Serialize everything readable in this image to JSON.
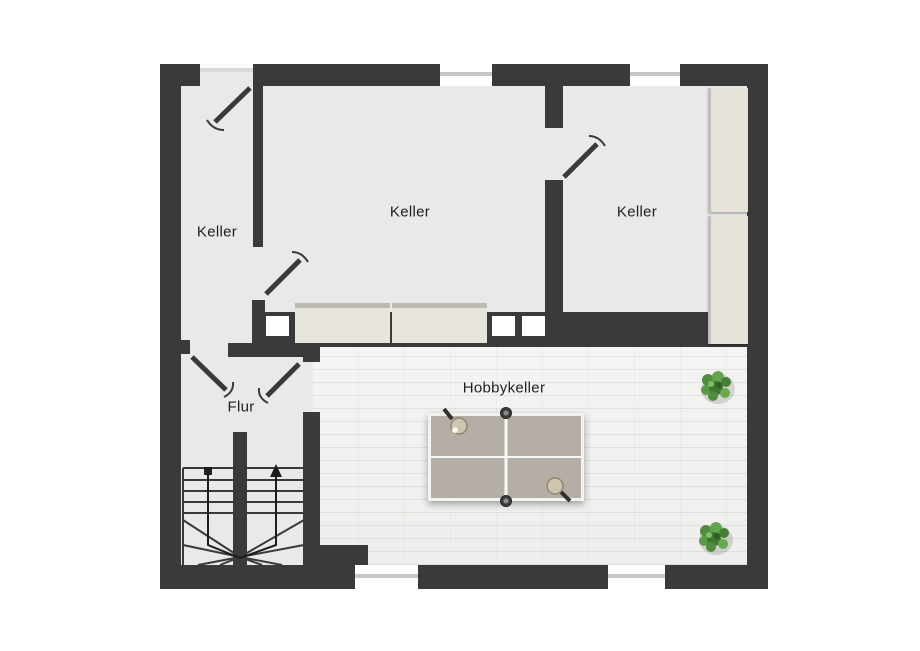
{
  "title": "Kellergeschoss Grundriss",
  "rooms": {
    "keller_left": {
      "label": "Keller"
    },
    "keller_center": {
      "label": "Keller"
    },
    "keller_right": {
      "label": "Keller"
    },
    "flur": {
      "label": "Flur"
    },
    "hobbykeller": {
      "label": "Hobbykeller"
    }
  },
  "colors": {
    "wall": "#3a3a3a",
    "room_floor": "#e9e9eb",
    "hobby_floor": "#f1f1ee",
    "furniture_beige": "#e7e4dc",
    "table_top": "#b4aea6",
    "table_lines": "#f7f7f5",
    "plant_green": "#55923f",
    "window_glass": "#c7c7c7",
    "background": "#ffffff",
    "label_text": "#1f1f1f"
  },
  "objects": {
    "staircase": "u-shaped-stair-with-up-arrow",
    "table": "table-tennis-table",
    "paddles": 2,
    "ball": 1,
    "plants": 2,
    "door_swings": 5,
    "windows_top": 2,
    "windows_bottom": 2,
    "wall_hatches": 3,
    "sideboard_segments": 2,
    "cabinet_segments": 2
  }
}
